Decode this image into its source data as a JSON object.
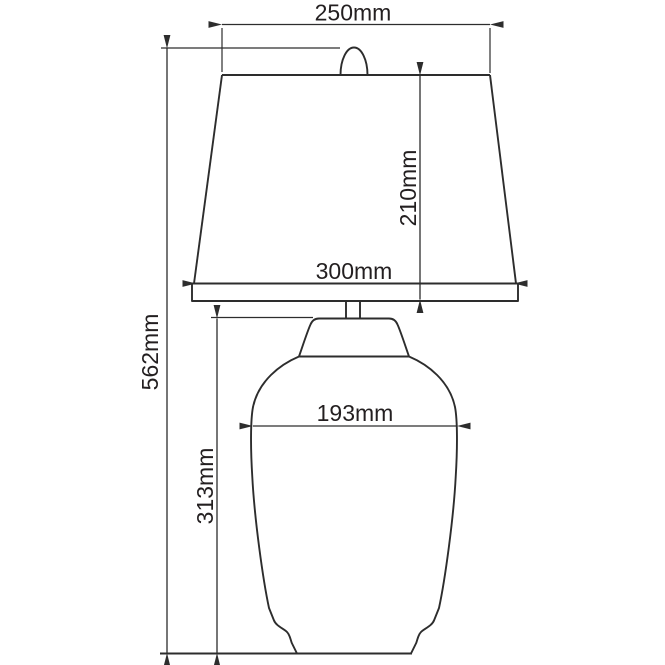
{
  "drawing": {
    "kind": "technical-dimension-drawing",
    "subject": "table lamp with tapered shade and vase-shaped base",
    "units": "mm",
    "background_color": "#ffffff",
    "line_color": "#2d2d2d",
    "text_color": "#231f20"
  },
  "labels": {
    "shade_top_width": "250mm",
    "shade_height": "210mm",
    "shade_bottom_width": "300mm",
    "overall_height": "562mm",
    "body_width": "193mm",
    "body_height": "313mm"
  }
}
